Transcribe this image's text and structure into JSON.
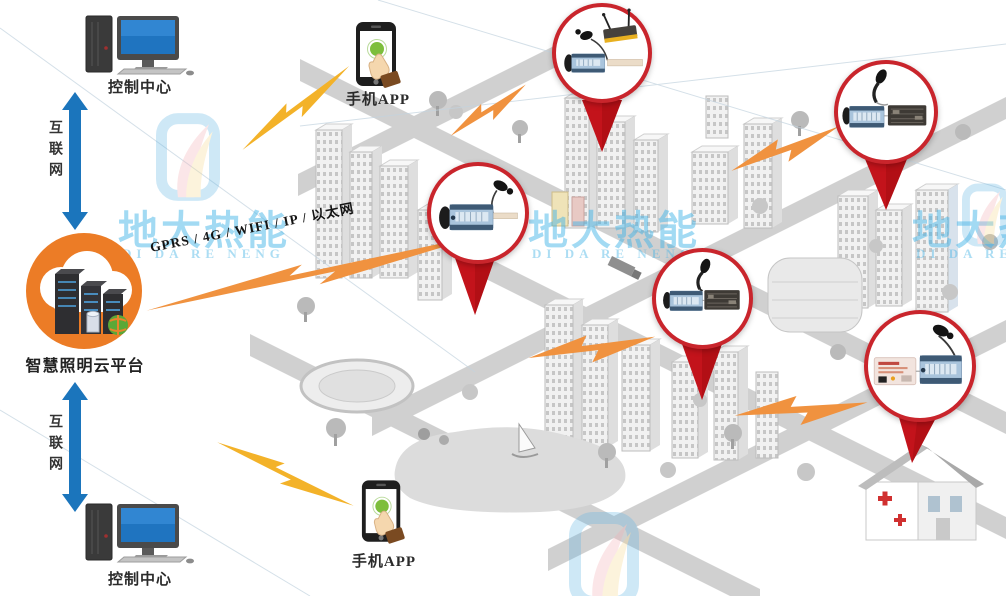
{
  "diagram": {
    "kind": "smart-lighting-cloud-architecture",
    "nodes": {
      "control_center_top": {
        "label": "控制中心"
      },
      "internet_top": {
        "label": "互联网"
      },
      "cloud_platform": {
        "label": "智慧照明云平台"
      },
      "internet_bottom": {
        "label": "互联网"
      },
      "control_center_bottom": {
        "label": "控制中心"
      },
      "phone_top": {
        "label": "手机APP"
      },
      "phone_bottom": {
        "label": "手机APP"
      }
    },
    "link": {
      "protocols": "GPRS / 4G / WIFI / IP / 以太网"
    },
    "callouts": [
      {
        "id": "callout-top-center",
        "devices": [
          "wireless-router",
          "antenna",
          "lamp-controller",
          "lamp-tube"
        ]
      },
      {
        "id": "callout-left-middle",
        "devices": [
          "lamp-controller",
          "antenna"
        ]
      },
      {
        "id": "callout-center",
        "devices": [
          "lamp-controller",
          "concentrator",
          "antenna"
        ]
      },
      {
        "id": "callout-top-right",
        "devices": [
          "lamp-controller",
          "concentrator",
          "antenna"
        ]
      },
      {
        "id": "callout-bottom-right",
        "devices": [
          "power-module",
          "lamp-controller",
          "antenna"
        ]
      }
    ]
  },
  "watermark": {
    "brand": "地大热能",
    "brand_en": "DI DA RE NENG"
  },
  "colors": {
    "cloud_orange": "#EC7C26",
    "arrow_blue": "#1B75BC",
    "callout_border_red": "#C9252C",
    "pointer_red": "#C3131B",
    "bolt_orange": "#F0923F",
    "bolt_yellow": "#F3B229",
    "watermark_blue": "#3FB3E8",
    "city_gray": "#C9C9C9"
  }
}
